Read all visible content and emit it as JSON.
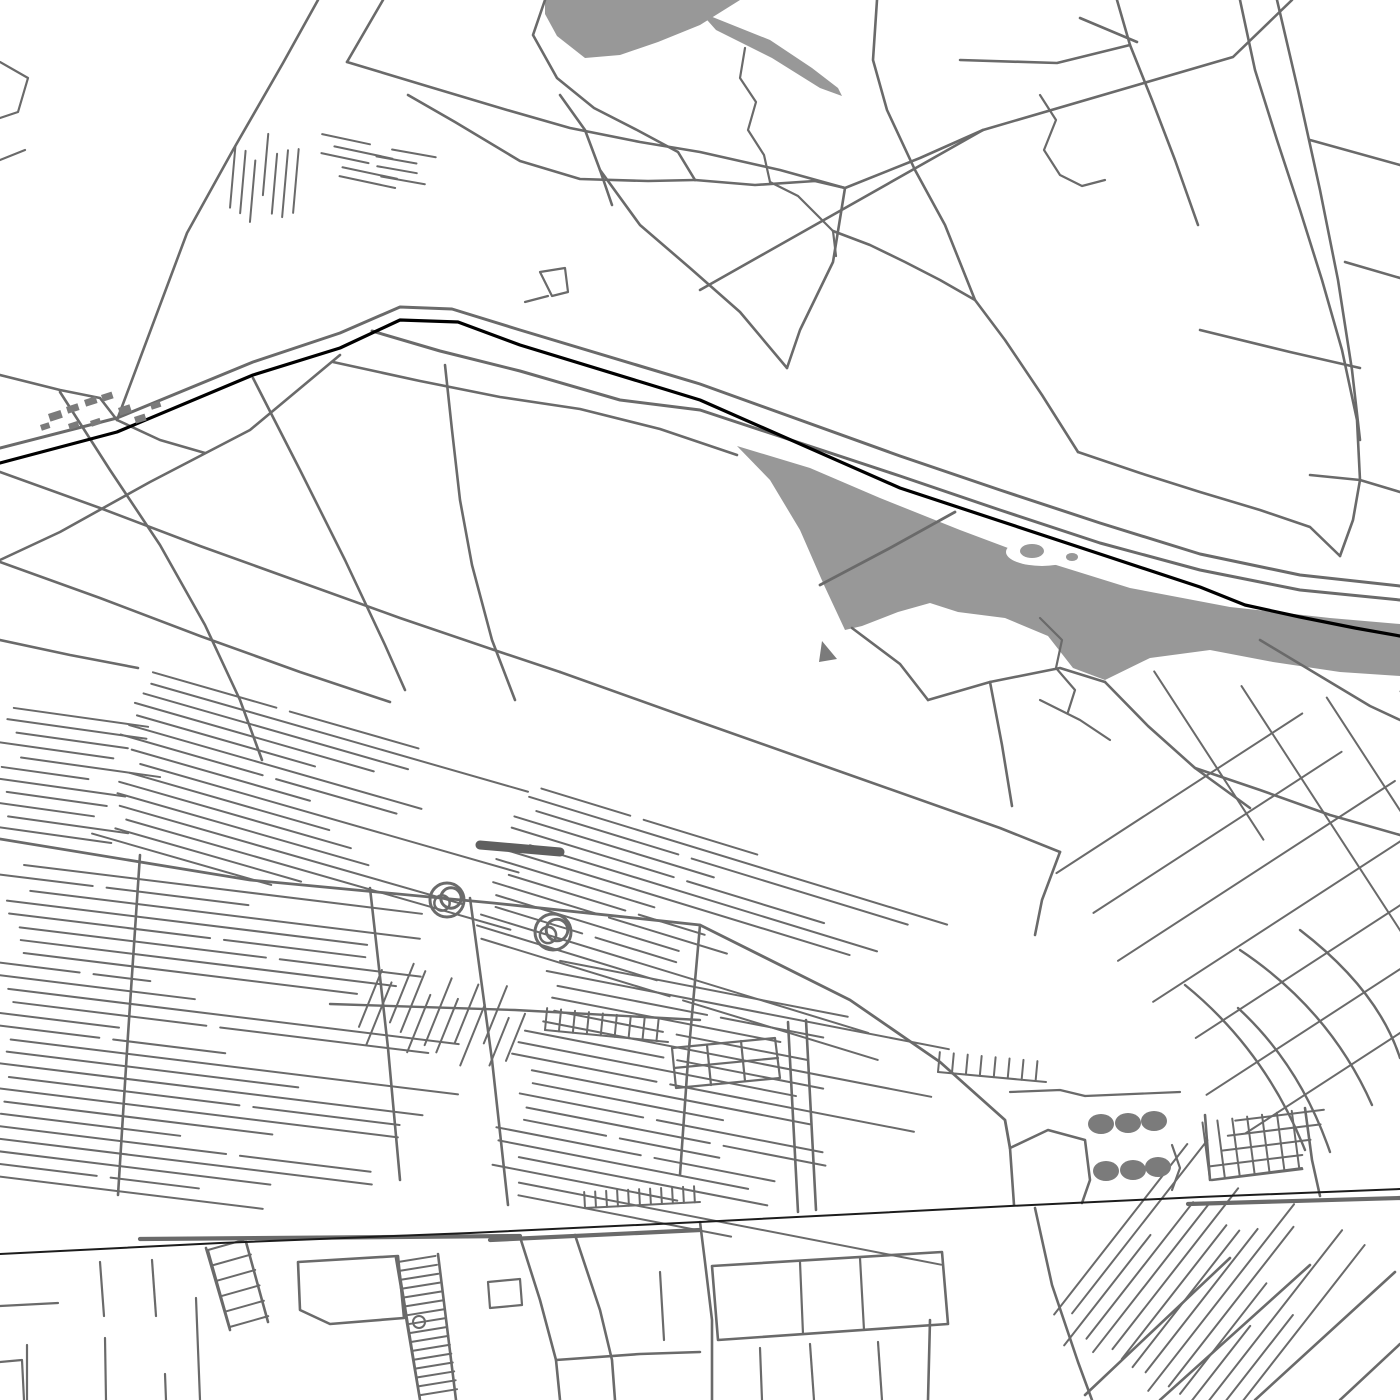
{
  "map": {
    "canvas": {
      "width": 1400,
      "height": 1400,
      "background": "#ffffff"
    },
    "colors": {
      "road": "#6a6a6a",
      "water": "#989898",
      "rail_major": "#000000",
      "rail_minor": "#1c1c1c",
      "landmark": "#7b7b7b",
      "building": "#5f5f5f",
      "background": "#ffffff"
    },
    "water_bodies": [
      {
        "name": "river-lake",
        "d": "M737 446 L810 468 L880 498 L960 530 L1040 560 L1130 588 L1230 607 L1330 618 L1400 624 L1400 676 L1340 672 L1273 662 L1210 650 L1150 658 L1105 680 L1073 668 L1048 636 L1005 618 L958 612 L930 603 L898 612 L862 626 L845 630 L824 585 L800 530 L770 480 Z"
      },
      {
        "name": "pond",
        "d": "M545 0 L740 0 L700 25 L658 42 L620 55 L585 58 L557 36 L545 14 Z"
      },
      {
        "name": "pond-tail",
        "d": "M700 12 L770 40 L812 68 L838 88 L842 96 L820 88 L772 58 L716 30 Z"
      }
    ],
    "island": {
      "cx": 1042,
      "cy": 552,
      "rx": 36,
      "ry": 14,
      "blob": {
        "cx": 1032,
        "cy": 551,
        "rx": 12,
        "ry": 7
      },
      "blob2": {
        "cx": 1072,
        "cy": 557,
        "rx": 6,
        "ry": 4
      }
    },
    "railways": [
      {
        "name": "main-railway",
        "d": "M0 463 L117 432 L253 375 L340 348 L400 320 L458 322 L520 345 L700 400 L900 488 L1000 521 L1100 554 L1200 587 L1245 605 L1300 617 L1355 628 L1400 636",
        "w": 3.2,
        "c": "rail_major"
      },
      {
        "name": "south-railway",
        "d": "M0 1254 L220 1243 L470 1233 L700 1222 L1010 1206 L1200 1197 L1400 1189",
        "w": 2,
        "c": "rail_minor"
      }
    ],
    "roads": [
      {
        "d": "M0 448 L117 418 L253 362 L340 333 L400 307 L452 309 L520 330 L700 384 L900 456 L1000 490 L1100 523 L1200 554 L1300 575 L1400 586",
        "w": 3
      },
      {
        "d": "M372 331 L440 351 L520 371 L620 400 L700 410 L900 476 L1000 510 L1100 543 L1200 570 L1300 590 L1400 600",
        "w": 3
      },
      {
        "d": "M333 362 L420 381 L500 397 L580 409 L660 429 L737 455"
      },
      {
        "d": "M820 585 L890 548 L955 512",
        "w": 2.8
      },
      {
        "d": "M852 628 L900 664 L928 700"
      },
      {
        "d": "M140 1239 L520 1236",
        "w": 4.2
      },
      {
        "d": "M490 1240 L700 1230",
        "w": 4.2
      },
      {
        "d": "M1188 1204 L1400 1198",
        "w": 4.2
      },
      {
        "d": "M318 0 L283 63 L233 150 L187 233 L117 420"
      },
      {
        "d": "M383 0 L347 62"
      },
      {
        "d": "M347 62 L430 87 L507 110 L570 128 L640 142 L700 152 L780 170 L845 188"
      },
      {
        "d": "M845 188 L833 262 L800 330 L787 368"
      },
      {
        "d": "M700 290 L983 130 L1233 57 L1292 0"
      },
      {
        "d": "M545 0 L533 35 L557 78 L594 108 L637 130 L678 152 L695 180"
      },
      {
        "d": "M695 180 L648 181 L580 179 L520 161 L455 122 L408 95"
      },
      {
        "d": "M695 180 L755 185 L815 181 L845 188"
      },
      {
        "d": "M745 48 L740 78 L756 102 L748 130 L764 155 L770 182",
        "w": 2.2
      },
      {
        "d": "M770 182 L798 196 L816 214 L833 231 L836 256",
        "w": 2.2
      },
      {
        "d": "M1040 95 L1056 120 L1044 150 L1060 175 L1082 186 L1105 180",
        "w": 2.2
      },
      {
        "d": "M833 231 L870 245 L905 262 L940 280 L975 300"
      },
      {
        "d": "M877 0 L873 60 L887 110 L915 170 L945 225 L975 300 L1005 340 L1042 395 L1078 452"
      },
      {
        "d": "M1240 0 L1255 70 L1277 140 L1300 210 L1322 280 L1342 350 L1357 420 L1360 480"
      },
      {
        "d": "M1277 0 L1298 90 L1320 190 L1338 280 L1352 370 L1360 440"
      },
      {
        "d": "M960 60 L1057 63 L1130 45"
      },
      {
        "d": "M1137 42 L1080 18"
      },
      {
        "d": "M1117 0 L1130 45 L1152 100 L1175 160 L1198 225"
      },
      {
        "d": "M1310 140 L1400 165"
      },
      {
        "d": "M1345 262 L1400 278"
      },
      {
        "d": "M1200 330 L1290 352 L1360 368"
      },
      {
        "d": "M1310 475 L1360 480 L1400 492"
      },
      {
        "d": "M1360 480 L1353 520 L1340 556"
      },
      {
        "d": "M1078 452 L1140 473 L1200 492 L1260 510 L1310 527 L1340 556"
      },
      {
        "d": "M560 95 L585 130 L600 170 L612 205"
      },
      {
        "d": "M600 170 L640 225 L690 268 L740 312 L787 368"
      },
      {
        "d": "M540 272 L565 268 L568 292 L552 296 L540 272",
        "w": 2.2
      },
      {
        "d": "M525 302 L548 296",
        "w": 2.2
      },
      {
        "d": "M0 62 L28 78 L18 112 L0 118",
        "w": 2.2
      },
      {
        "d": "M0 160 L25 150",
        "w": 2.2
      },
      {
        "d": "M845 188 L920 158 L983 130"
      },
      {
        "d": "M0 375 L60 390 L100 398 L117 420"
      },
      {
        "d": "M117 420 L160 440 L205 453"
      },
      {
        "d": "M340 355 L250 430 L150 482 L60 532 L0 560"
      },
      {
        "d": "M0 472 L100 508 L200 546 L300 582 L400 618 L500 652 L560 672"
      },
      {
        "d": "M0 562 L100 598 L200 636 L300 672 L390 702"
      },
      {
        "d": "M0 640 L70 655 L138 668"
      },
      {
        "d": "M60 392 L110 470 L160 545 L205 625 L240 700 L262 760"
      },
      {
        "d": "M253 378 L300 470 L345 560 L385 645 L405 690"
      },
      {
        "d": "M445 365 L452 430 L460 500 L472 565 L492 640 L515 700"
      },
      {
        "d": "M560 672 L700 722 L850 775 L1000 828 L1060 852"
      },
      {
        "d": "M0 839 L250 880 L493 903 L700 925 L850 1000 L940 1062 L1005 1120 L1010 1148",
        "w": 2.8
      },
      {
        "d": "M140 855 L128 1035 L118 1195"
      },
      {
        "d": "M370 888 L388 1048 L400 1180"
      },
      {
        "d": "M470 898 L492 1060 L508 1205"
      },
      {
        "d": "M700 925 L688 1060 L680 1175"
      },
      {
        "d": "M788 1022 L798 1212"
      },
      {
        "d": "M806 1020 L816 1210"
      },
      {
        "d": "M928 700 L990 682 L1060 668 L1105 682"
      },
      {
        "d": "M1105 682 L1148 726 L1195 768 L1250 808"
      },
      {
        "d": "M990 682 L1002 745 L1012 806"
      },
      {
        "d": "M1260 640 L1320 676 L1370 706 L1400 720"
      },
      {
        "d": "M1195 768 L1260 790 L1330 815 L1400 835"
      },
      {
        "d": "M1060 852 L1042 900 L1035 935"
      },
      {
        "d": "M1240 950 Q1330 1010 1372 1105",
        "w": 2.4
      },
      {
        "d": "M1300 930 Q1378 990 1400 1058",
        "w": 2.4
      },
      {
        "d": "M1185 985 Q1265 1050 1305 1150",
        "w": 2.4
      },
      {
        "d": "M1238 1008 Q1300 1065 1330 1152",
        "w": 2.4
      },
      {
        "d": "M1040 618 L1062 640 L1056 668 L1075 690 L1068 712",
        "w": 2.2
      },
      {
        "d": "M1040 700 L1080 720 L1110 740",
        "w": 2.2
      },
      {
        "d": "M1010 1148 L1048 1130 L1085 1140 L1090 1180 L1082 1203"
      },
      {
        "d": "M1010 1148 L1014 1205"
      },
      {
        "d": "M1172 1145 L1180 1168 L1172 1190",
        "w": 2.2
      },
      {
        "d": "M1085 1096 L1180 1092",
        "w": 2.2
      },
      {
        "d": "M1010 1092 L1060 1090 L1085 1096",
        "w": 2.2
      },
      {
        "d": "M1305 1108 L1312 1160 L1320 1196"
      },
      {
        "d": "M1205 1115 L1210 1180"
      },
      {
        "d": "M520 1237 L540 1300 L556 1360 L560 1400"
      },
      {
        "d": "M575 1235 L600 1310 L612 1360 L615 1400"
      },
      {
        "d": "M700 1222 L705 1262 L712 1320 L712 1400"
      },
      {
        "d": "M712 1266 L942 1252 L948 1324 L718 1340 Z"
      },
      {
        "d": "M800 1262 L803 1334",
        "w": 2.2
      },
      {
        "d": "M860 1258 L864 1330",
        "w": 2.2
      },
      {
        "d": "M930 1320 L928 1400"
      },
      {
        "d": "M878 1342 L882 1400",
        "w": 2.2
      },
      {
        "d": "M556 1360 L640 1354 L700 1352"
      },
      {
        "d": "M760 1348 L762 1400",
        "w": 2.2
      },
      {
        "d": "M810 1344 L814 1400",
        "w": 2.2
      },
      {
        "d": "M660 1272 L664 1340",
        "w": 2.2
      },
      {
        "d": "M1085 1395 L1230 1258"
      },
      {
        "d": "M1160 1400 L1310 1265"
      },
      {
        "d": "M1255 1400 L1395 1272"
      },
      {
        "d": "M1340 1400 L1400 1344"
      },
      {
        "d": "M1035 1208 L1052 1285 L1078 1362 L1092 1400"
      },
      {
        "d": "M298 1262 L398 1256 L404 1318 L330 1324 L300 1310 Z"
      },
      {
        "d": "M206 1248 L230 1330"
      },
      {
        "d": "M246 1242 L268 1322"
      },
      {
        "d": "M396 1258 L420 1400"
      },
      {
        "d": "M438 1254 L456 1400"
      },
      {
        "d": "M27 1345 L27 1400",
        "w": 2.2
      },
      {
        "d": "M105 1338 L106 1400",
        "w": 2.2
      },
      {
        "d": "M165 1374 L166 1400",
        "w": 2.2
      },
      {
        "d": "M196 1298 L200 1400",
        "w": 2.2
      },
      {
        "d": "M0 1362 L22 1360 L24 1400",
        "w": 2.2
      },
      {
        "d": "M0 1306 L58 1303",
        "w": 2.2
      },
      {
        "d": "M100 1262 L104 1316",
        "w": 2.2
      },
      {
        "d": "M152 1260 L156 1316",
        "w": 2.2
      },
      {
        "d": "M488 1282 L520 1279 L522 1305 L490 1308 Z",
        "w": 2.2
      },
      {
        "d": "M330 1004 L515 1010 L700 1020",
        "w": 2.4
      },
      {
        "d": "M672 1048 L775 1038 L780 1078 L676 1088 Z",
        "w": 2.2
      },
      {
        "d": "M707 1045 L711 1085",
        "w": 2.2
      },
      {
        "d": "M741 1041 L745 1081",
        "w": 2.2
      },
      {
        "d": "M674 1068 L778 1058",
        "w": 2.2
      },
      {
        "d": "M480 845 L560 852",
        "w": 9,
        "c": "building"
      }
    ],
    "hatch_fields": [
      {
        "name": "plots-a",
        "x": 237,
        "y": 128,
        "angle": 95,
        "count": 7,
        "sx": 10.5,
        "sy": 1,
        "min": 52,
        "max": 70,
        "seed": 11
      },
      {
        "name": "plots-b",
        "x": 312,
        "y": 132,
        "angle": 12,
        "count": 5,
        "sx": 2,
        "sy": 10,
        "min": 48,
        "max": 60,
        "seed": 12
      },
      {
        "name": "plots-c",
        "x": 372,
        "y": 146,
        "angle": 10,
        "count": 4,
        "sx": 2,
        "sy": 10,
        "min": 40,
        "max": 52,
        "seed": 13
      },
      {
        "name": "belt-west",
        "x": 138,
        "y": 668,
        "angle": 16,
        "count": 16,
        "sx": -3.2,
        "sy": 11,
        "min": 160,
        "max": 420,
        "seed": 21,
        "split": 0.3
      },
      {
        "name": "belt-east",
        "x": 520,
        "y": 782,
        "angle": 17,
        "count": 15,
        "sx": -3.4,
        "sy": 11,
        "min": 150,
        "max": 470,
        "seed": 22,
        "split": 0.3
      },
      {
        "name": "left-band",
        "x": 0,
        "y": 862,
        "angle": 7,
        "count": 26,
        "sx": -1.5,
        "sy": 12.4,
        "min": 100,
        "max": 460,
        "seed": 31,
        "split": 0.35
      },
      {
        "name": "left-band-upper",
        "x": 0,
        "y": 706,
        "angle": 8,
        "count": 11,
        "sx": -1.7,
        "sy": 11.9,
        "min": 80,
        "max": 150,
        "seed": 32
      },
      {
        "name": "center-band",
        "x": 530,
        "y": 955,
        "angle": 11,
        "count": 20,
        "sx": -2.4,
        "sy": 12.3,
        "min": 120,
        "max": 460,
        "seed": 41,
        "split": 0.3
      },
      {
        "name": "center-dividers",
        "x": 390,
        "y": 950,
        "angle": 112,
        "count": 12,
        "sx": 13,
        "sy": 4,
        "min": 50,
        "max": 75,
        "seed": 42
      },
      {
        "name": "ne-grid-long",
        "x": 1052,
        "y": 876,
        "angle": -33,
        "count": 7,
        "sx": 29,
        "sy": 45,
        "min": 280,
        "max": 460,
        "seed": 51
      },
      {
        "name": "ne-grid-cross",
        "x": 1150,
        "y": 665,
        "angle": 57,
        "count": 4,
        "sx": 83,
        "sy": 8,
        "min": 200,
        "max": 330,
        "seed": 52
      },
      {
        "name": "se-fan",
        "x": 1042,
        "y": 1330,
        "angle": -52,
        "count": 16,
        "sx": 10.6,
        "sy": 8.3,
        "min": 110,
        "max": 260,
        "seed": 61
      },
      {
        "name": "brick-rows",
        "x": 1208,
        "y": 1124,
        "angle": -7,
        "count": 5,
        "sx": -1.8,
        "sy": 14.4,
        "min": 88,
        "max": 96,
        "seed": 71
      }
    ],
    "combs": [
      {
        "name": "ladder-small",
        "x1": 208,
        "y1": 1250,
        "x2": 230,
        "y2": 1328,
        "tooth": 40,
        "step": 16
      },
      {
        "name": "ladder-dense",
        "x1": 398,
        "y1": 1262,
        "x2": 420,
        "y2": 1398,
        "tooth": 38,
        "step": 9
      },
      {
        "name": "brick-dividers",
        "x1": 1210,
        "y1": 1180,
        "x2": 1302,
        "y2": 1168,
        "tooth": 58,
        "step": 15
      },
      {
        "name": "plot-comb-1",
        "x1": 545,
        "y1": 1030,
        "x2": 668,
        "y2": 1042,
        "tooth": 22,
        "step": 14
      },
      {
        "name": "plot-comb-2",
        "x1": 938,
        "y1": 1072,
        "x2": 1046,
        "y2": 1082,
        "tooth": 20,
        "step": 14
      },
      {
        "name": "plot-comb-3",
        "x1": 585,
        "y1": 1208,
        "x2": 700,
        "y2": 1202,
        "tooth": 16,
        "step": 11
      }
    ],
    "landmark_dots": [
      {
        "cx": 1101,
        "cy": 1124,
        "rx": 13,
        "ry": 10
      },
      {
        "cx": 1128,
        "cy": 1123,
        "rx": 13,
        "ry": 10
      },
      {
        "cx": 1154,
        "cy": 1121,
        "rx": 13,
        "ry": 10
      },
      {
        "cx": 1106,
        "cy": 1171,
        "rx": 13,
        "ry": 10
      },
      {
        "cx": 1133,
        "cy": 1170,
        "rx": 13,
        "ry": 10
      },
      {
        "cx": 1158,
        "cy": 1167,
        "rx": 13,
        "ry": 10
      }
    ],
    "roundabout_scribbles": [
      {
        "cx": 447,
        "cy": 900,
        "r": 17
      },
      {
        "cx": 553,
        "cy": 932,
        "r": 18
      }
    ],
    "buildings": [
      {
        "x": 48,
        "y": 414,
        "w": 13,
        "h": 8,
        "rot": -18
      },
      {
        "x": 66,
        "y": 407,
        "w": 12,
        "h": 7,
        "rot": -18
      },
      {
        "x": 84,
        "y": 400,
        "w": 12,
        "h": 7,
        "rot": -18
      },
      {
        "x": 101,
        "y": 395,
        "w": 11,
        "h": 7,
        "rot": -18
      },
      {
        "x": 118,
        "y": 408,
        "w": 12,
        "h": 8,
        "rot": -18
      },
      {
        "x": 134,
        "y": 417,
        "w": 11,
        "h": 7,
        "rot": -18
      },
      {
        "x": 90,
        "y": 421,
        "w": 10,
        "h": 6,
        "rot": -18
      },
      {
        "x": 68,
        "y": 424,
        "w": 10,
        "h": 6,
        "rot": -18
      },
      {
        "x": 150,
        "y": 404,
        "w": 10,
        "h": 6,
        "rot": -18
      },
      {
        "x": 40,
        "y": 425,
        "w": 9,
        "h": 6,
        "rot": -18
      }
    ],
    "ground_marks": [
      {
        "name": "small-triangle",
        "d": "M822 641 L837 659 L819 662 Z"
      }
    ],
    "small_circle": {
      "cx": 419,
      "cy": 1322,
      "r": 6
    }
  }
}
